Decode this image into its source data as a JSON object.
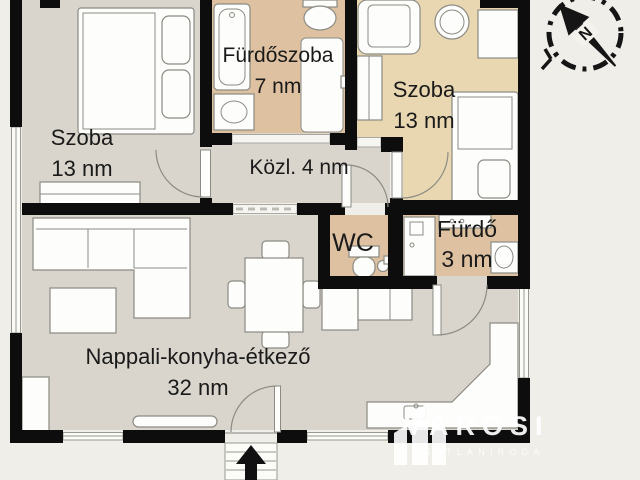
{
  "page": {
    "background": "#f0eee8"
  },
  "colors": {
    "wall": "#0d0d0d",
    "floor_gray": "#d9d5cc",
    "floor_tan": "#ddc1a0",
    "floor_wheat": "#e9d7b1",
    "furniture_outline": "#8b8b84",
    "text": "#1a1a1a",
    "logo_white": "#ffffff"
  },
  "rooms": {
    "szoba_left": {
      "name": "Szoba",
      "area": "13 nm"
    },
    "furdoszoba": {
      "name": "Fürdőszoba",
      "area": "7 nm"
    },
    "szoba_right": {
      "name": "Szoba",
      "area": "13 nm"
    },
    "kozlekedo": {
      "label": "Közl. 4 nm"
    },
    "wc": {
      "name": "WC"
    },
    "furdo": {
      "name": "Fürdő",
      "area": "3 nm"
    },
    "nappali": {
      "name": "Nappali-konyha-étkező",
      "area": "32 nm"
    }
  },
  "compass": {
    "north": "N"
  },
  "logo": {
    "brand": "VÁROSI",
    "tagline": "INGATLANIRODA"
  }
}
